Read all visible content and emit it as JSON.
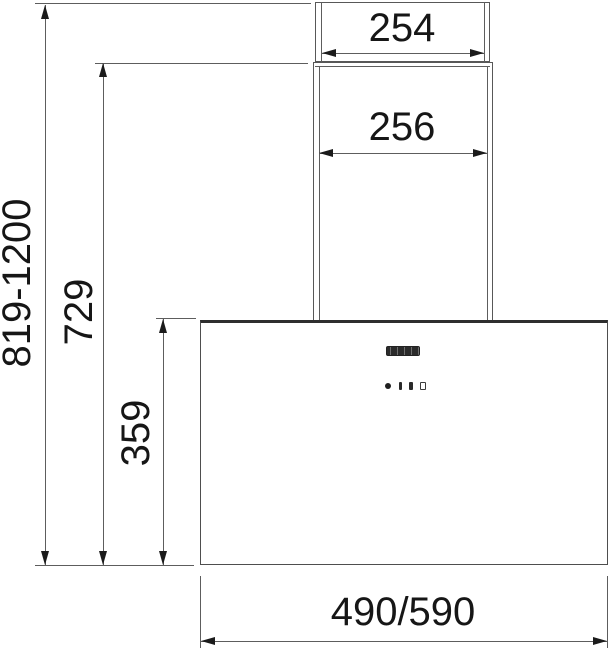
{
  "drawing": {
    "type": "technical-dimension-diagram",
    "subject": "wall-mounted cooker hood front view",
    "labels": {
      "upper_chimney_width": "254",
      "lower_chimney_width": "256",
      "overall_height_range": "819-1200",
      "chimney_height": "729",
      "body_height": "359",
      "body_width": "490/590"
    },
    "hood": {
      "logo_block": "brand-logo-block",
      "control_icons": [
        "power-dot-icon",
        "fan-speed-1-bar-icon",
        "fan-speed-2-bar-icon",
        "fan-speed-3-outline-icon"
      ]
    },
    "colors": {
      "background": "#ffffff",
      "outline": "#585858",
      "dimension_line": "#5d5d5d",
      "arrow": "#1b1b1b",
      "text": "#161616",
      "body_top_edge": "#2e2e2e",
      "logo": "#2b2b2b"
    }
  }
}
